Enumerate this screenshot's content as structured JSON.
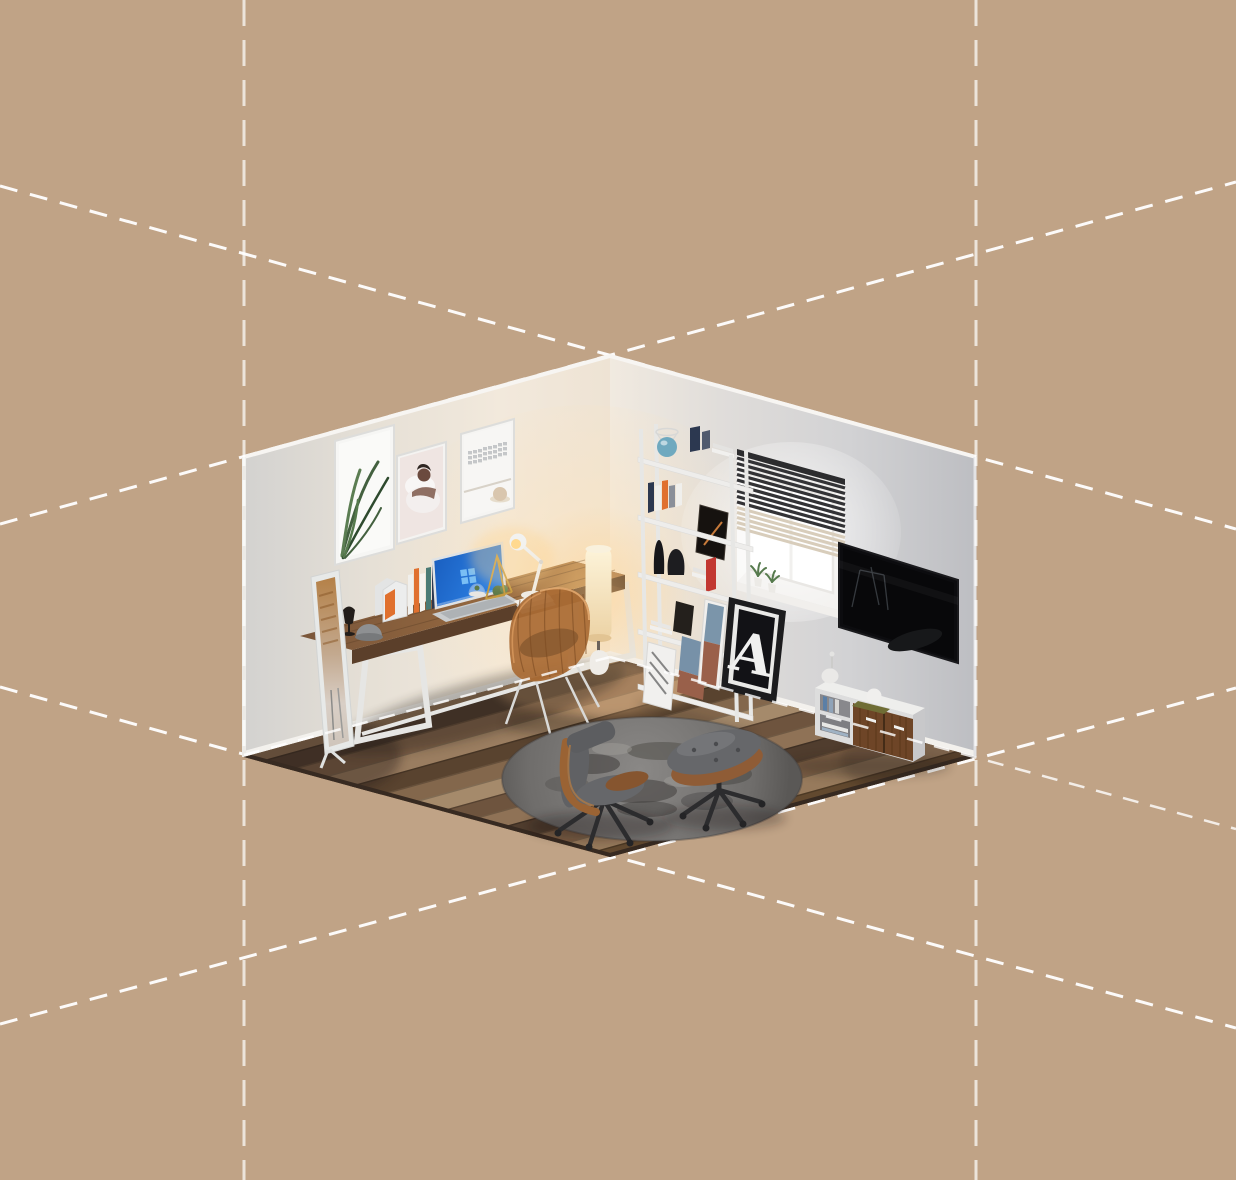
{
  "scene": {
    "description": "Isometric 3D render of a cozy home office corner room floating on a tan background with white dashed isometric guide lines extending the room's cube edges",
    "style": "isometric cutaway, two walls and a wood plank floor",
    "background_color": "#c0a386",
    "guide_lines": {
      "color": "#ffffff",
      "style": "dashed",
      "count": 8
    }
  },
  "poster": {
    "letter": "A"
  },
  "palette": {
    "bg": "#c0a386",
    "dashWhite": "#ffffff",
    "wallWarm": "#f2e9dc",
    "wallCool": "#c6c7ca",
    "floorDark": "#5d4836",
    "deskWood": "#95683f",
    "doorWood": "#6e4527",
    "walnut": "#8f5c36",
    "copper": "#a96a33",
    "cushionGray": "#66676a",
    "rugGray": "#787674",
    "orange": "#e0702e",
    "red": "#c23730",
    "navy": "#2c3850",
    "teal": "#4a7a74",
    "glassBlue": "#6fa9bf",
    "screenBlue": "#2175dd",
    "slatDark": "#333336",
    "slatCream": "#d8cdbb",
    "olive": "#6f6d35",
    "gold": "#c49a3f",
    "tvBlack": "#0c0c0f",
    "white": "#efeeec",
    "frameDark": "#1c1c1e",
    "plantGreen": "#567a4d",
    "lampGlow": "#ffd58f"
  },
  "floor": {
    "plank_colors": [
      "#6b5140",
      "#8a6d52",
      "#4c3a2d",
      "#7c5f47",
      "#9a7d60",
      "#59432f",
      "#83674c",
      "#a58a6b",
      "#6e543e",
      "#8f7256",
      "#503d2e",
      "#7a5d44",
      "#977a5c",
      "#62492f",
      "#86674a",
      "#715740"
    ]
  },
  "rug": {
    "patches": [
      {
        "dx": -60,
        "dy": -15,
        "rx": 28,
        "ry": 10,
        "c": "#4e4c4a",
        "o": 0.7
      },
      {
        "dx": 10,
        "dy": -28,
        "rx": 35,
        "ry": 9,
        "c": "#55534f",
        "o": 0.6
      },
      {
        "dx": 70,
        "dy": -5,
        "rx": 30,
        "ry": 11,
        "c": "#504e4c",
        "o": 0.65
      },
      {
        "dx": -15,
        "dy": 12,
        "rx": 40,
        "ry": 12,
        "c": "#474543",
        "o": 0.6
      },
      {
        "dx": 55,
        "dy": 22,
        "rx": 26,
        "ry": 9,
        "c": "#525050",
        "o": 0.55
      },
      {
        "dx": -85,
        "dy": 5,
        "rx": 22,
        "ry": 8,
        "c": "#585654",
        "o": 0.5
      },
      {
        "dx": 30,
        "dy": 2,
        "rx": 18,
        "ry": 6,
        "c": "#9d9b98",
        "o": 0.5
      },
      {
        "dx": -40,
        "dy": -30,
        "rx": 20,
        "ry": 6,
        "c": "#a19f9c",
        "o": 0.45
      },
      {
        "dx": 90,
        "dy": -25,
        "rx": 18,
        "ry": 6,
        "c": "#969491",
        "o": 0.4
      },
      {
        "dx": -5,
        "dy": 30,
        "rx": 30,
        "ry": 8,
        "c": "#434140",
        "o": 0.5
      }
    ]
  },
  "objects": [
    "wall frame with plant art",
    "wall frame with portrait art",
    "wall frame with keyboard photo",
    "standing mirror",
    "wooden desk with white metal legs",
    "laptop with blue screen",
    "desk lamp",
    "file organizers and books",
    "geometric terrarium",
    "copper wire chair",
    "glowing floor lamp",
    "white ladder bookshelf",
    "blue glass lamp",
    "black vases",
    "red book",
    "window with venetian blinds",
    "windowsill plants",
    "wall mounted tv",
    "letter A framed poster",
    "white tv credenza with wood doors",
    "humidifier",
    "round gray shag rug",
    "eames lounge chair",
    "eames ottoman"
  ]
}
